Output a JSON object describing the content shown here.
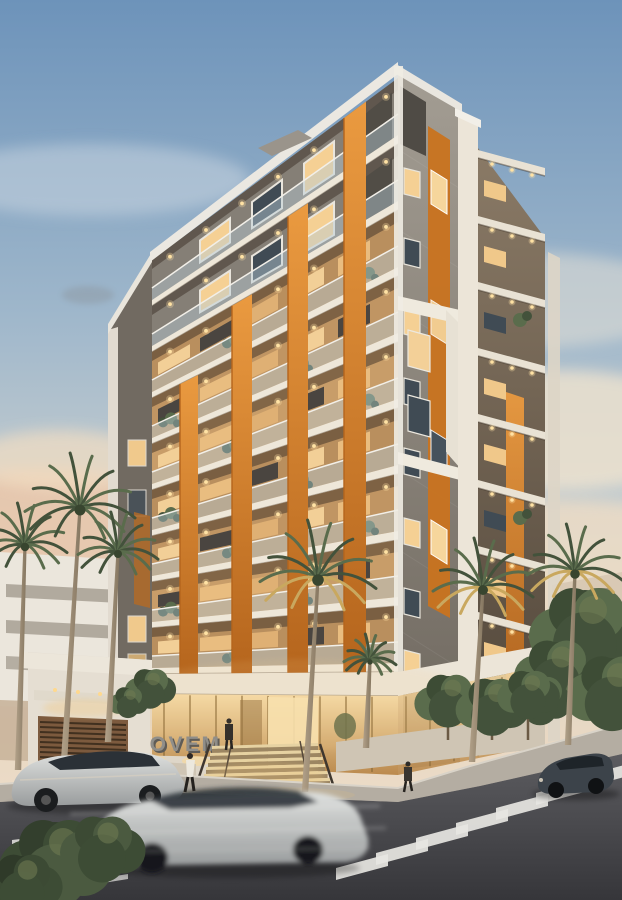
{
  "image": {
    "kind": "architectural-rendering",
    "sign_text": "NOVEM"
  },
  "palette": {
    "sky_top": "#6d93ba",
    "sky_mid": "#9fb7cb",
    "sky_low": "#ccd1d0",
    "sky_horizon": "#e9d8c3",
    "sunset_peach": "#eec3a3",
    "cloud_cream": "#f1e3cc",
    "facade_white": "#efe9dd",
    "facade_gray": "#8d877d",
    "facade_gray_dark": "#6b655c",
    "flank_gray": "#716a61",
    "accent_orange": "#dd8028",
    "accent_orange_deep": "#b5651d",
    "window_warm": "#f5d094",
    "window_dark": "#404b54",
    "glass_rail": "#b7cdd8",
    "lobby_glass_top": "#f6dca8",
    "lobby_glass_bottom": "#bb8a4e",
    "mullion_gold": "#8a6a38",
    "sign_letters": "#908e89",
    "sign_plinth": "#ded6c8",
    "street_asphalt": "#47474b",
    "sidewalk": "#b4ada2",
    "marking_white": "#e7e6e2",
    "palm_dark": "#43523b",
    "palm_mid": "#5a6c4c",
    "palm_gold": "#c9a85f",
    "shrub": "#3d4c35",
    "trunk": "#a08f79",
    "car_silver": "#ced0cf",
    "car_dark": "#3c434a",
    "light_dot": "#ffe2a4"
  }
}
